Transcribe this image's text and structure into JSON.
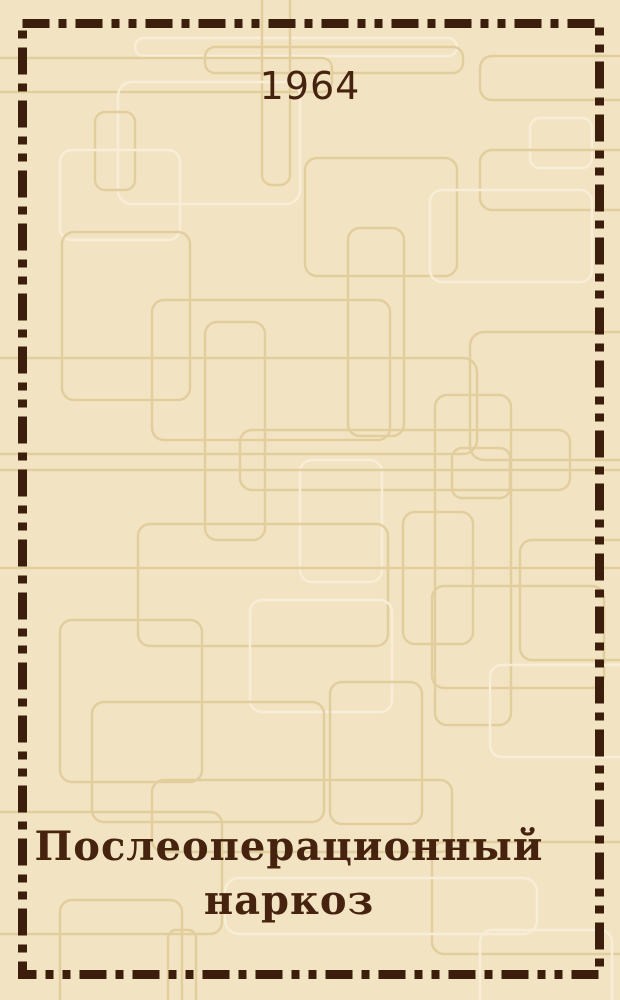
{
  "cover": {
    "year": "1964",
    "title": "Послеоперационный наркоз",
    "title_lines": [
      "Послеоперационный",
      "наркоз"
    ],
    "colors": {
      "background": "#f2e3c2",
      "pattern_line_dark": "#e2cd9d",
      "pattern_line_light": "#f8eed8",
      "frame_ink": "#3b1f0c",
      "text_ink": "#46230f"
    }
  }
}
